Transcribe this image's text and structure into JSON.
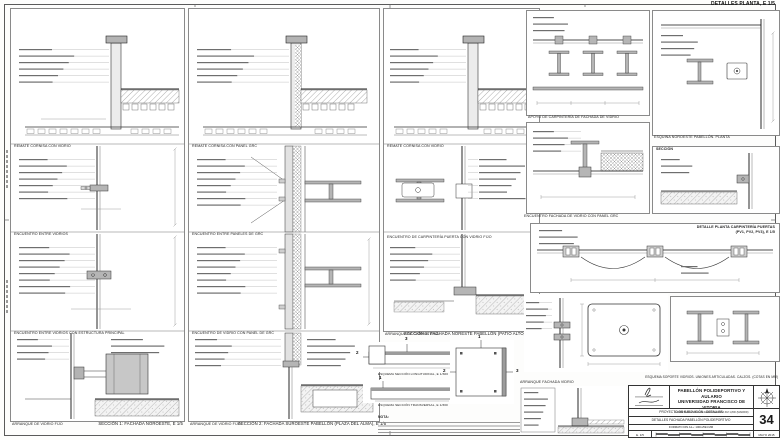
{
  "header": {
    "plan_details_title": "DETALLES PLANTA, E 1/5"
  },
  "columns": [
    {
      "sub_captions": [
        "REMATE CORNISA CON VIDRIO",
        "ENCUENTRO ENTRE VIDRIOS",
        "ENCUENTRO ENTRE VIDRIOS CON ESTRUCTURA PRINCIPAL"
      ],
      "bottom_label": "ARRANQUE DE VIDRIO FIJO",
      "caption": "SECCIÓN 1: FACHADA NOROESTE, E 1/5"
    },
    {
      "sub_captions": [
        "REMATE CORNISA CON PANEL GRC",
        "ENCUENTRO ENTRE PANELES DE GRC",
        "ENCUENTRO DE VIDRIO CON PANEL DE GRC"
      ],
      "bottom_label": "ARRANQUE DE VIDRIO FIJO",
      "caption": "SECCIÓN 2: FACHADA SUROESTE PABELLÓN (PLAZA DEL ALMA), E 1/5"
    },
    {
      "sub_captions": [
        "REMATE CORNISA CON VIDRIO",
        "ENCUENTRO DE CARPINTERÍA PUERTA CON VIDRIO FIJO"
      ],
      "bottom_label": "ARRANQUE DE CARPINTERÍA",
      "caption": "SECCIÓN 3: FACHADA NORESTE PABELLÓN (PATIO ALTO), E 1/5"
    }
  ],
  "key_plans": {
    "longitudinal_caption": "ESQUEMA SECCIÓN LONGITUDINAL, E 1/300",
    "transversal_caption": "ESQUEMA SECCIÓN TRANSVERSAL, E 1/300",
    "note_label": "NOTA:",
    "marker_1": "1",
    "marker_2": "2",
    "marker_3": "3"
  },
  "plan_details": {
    "apoyo_caption": "APOYO DE CARPINTERÍA DE FACHADA DE VIDRIO",
    "esquina_caption": "ESQUINA NOROESTE PABELLÓN. PLANTA",
    "seccion_label": "SECCIÓN",
    "encuentro_grc_caption": "ENCUENTRO FACHADA DE VIDRIO CON PANEL GRC",
    "puertas_caption_line1": "DETALLE PLANTA CARPINTERÍA PUERTAS",
    "puertas_caption_line2": "(PV1, PV2, PV3), E 1/5",
    "soporte_caption": "ESQUEMA SOPORTE VIDRIOS. UNIONES ARTICULADAS. CALZOS. (COTAS EN MM)",
    "arranque_caption": "ARRANQUE FACHADA VIDRIO"
  },
  "titleblock": {
    "project_line1": "PABELLÓN POLIDEPORTIVO Y AULARIO",
    "project_line2": "UNIVERSIDAD FRANCISCO DE VITORIA",
    "project_subtitle": "CARRETERA POZUELO-MAJADAHONDA KM 1,800 (MADRID)",
    "phase": "PROYECTO DE EJECUCIÓN - DETALLES",
    "sheet_title": "DETALLES FACHADA PABELLÓN POLIDEPORTIVO",
    "format": "FORMATO DIN A1+: 1001x594 MM",
    "sheet_number": "34",
    "scale": "E. 1/5",
    "date": "MAYO 2015"
  },
  "colors": {
    "line": "#2a2a2a",
    "steel_fill": "#b5b5b5",
    "leader": "#9b9b9b",
    "paper": "#ffffff"
  }
}
